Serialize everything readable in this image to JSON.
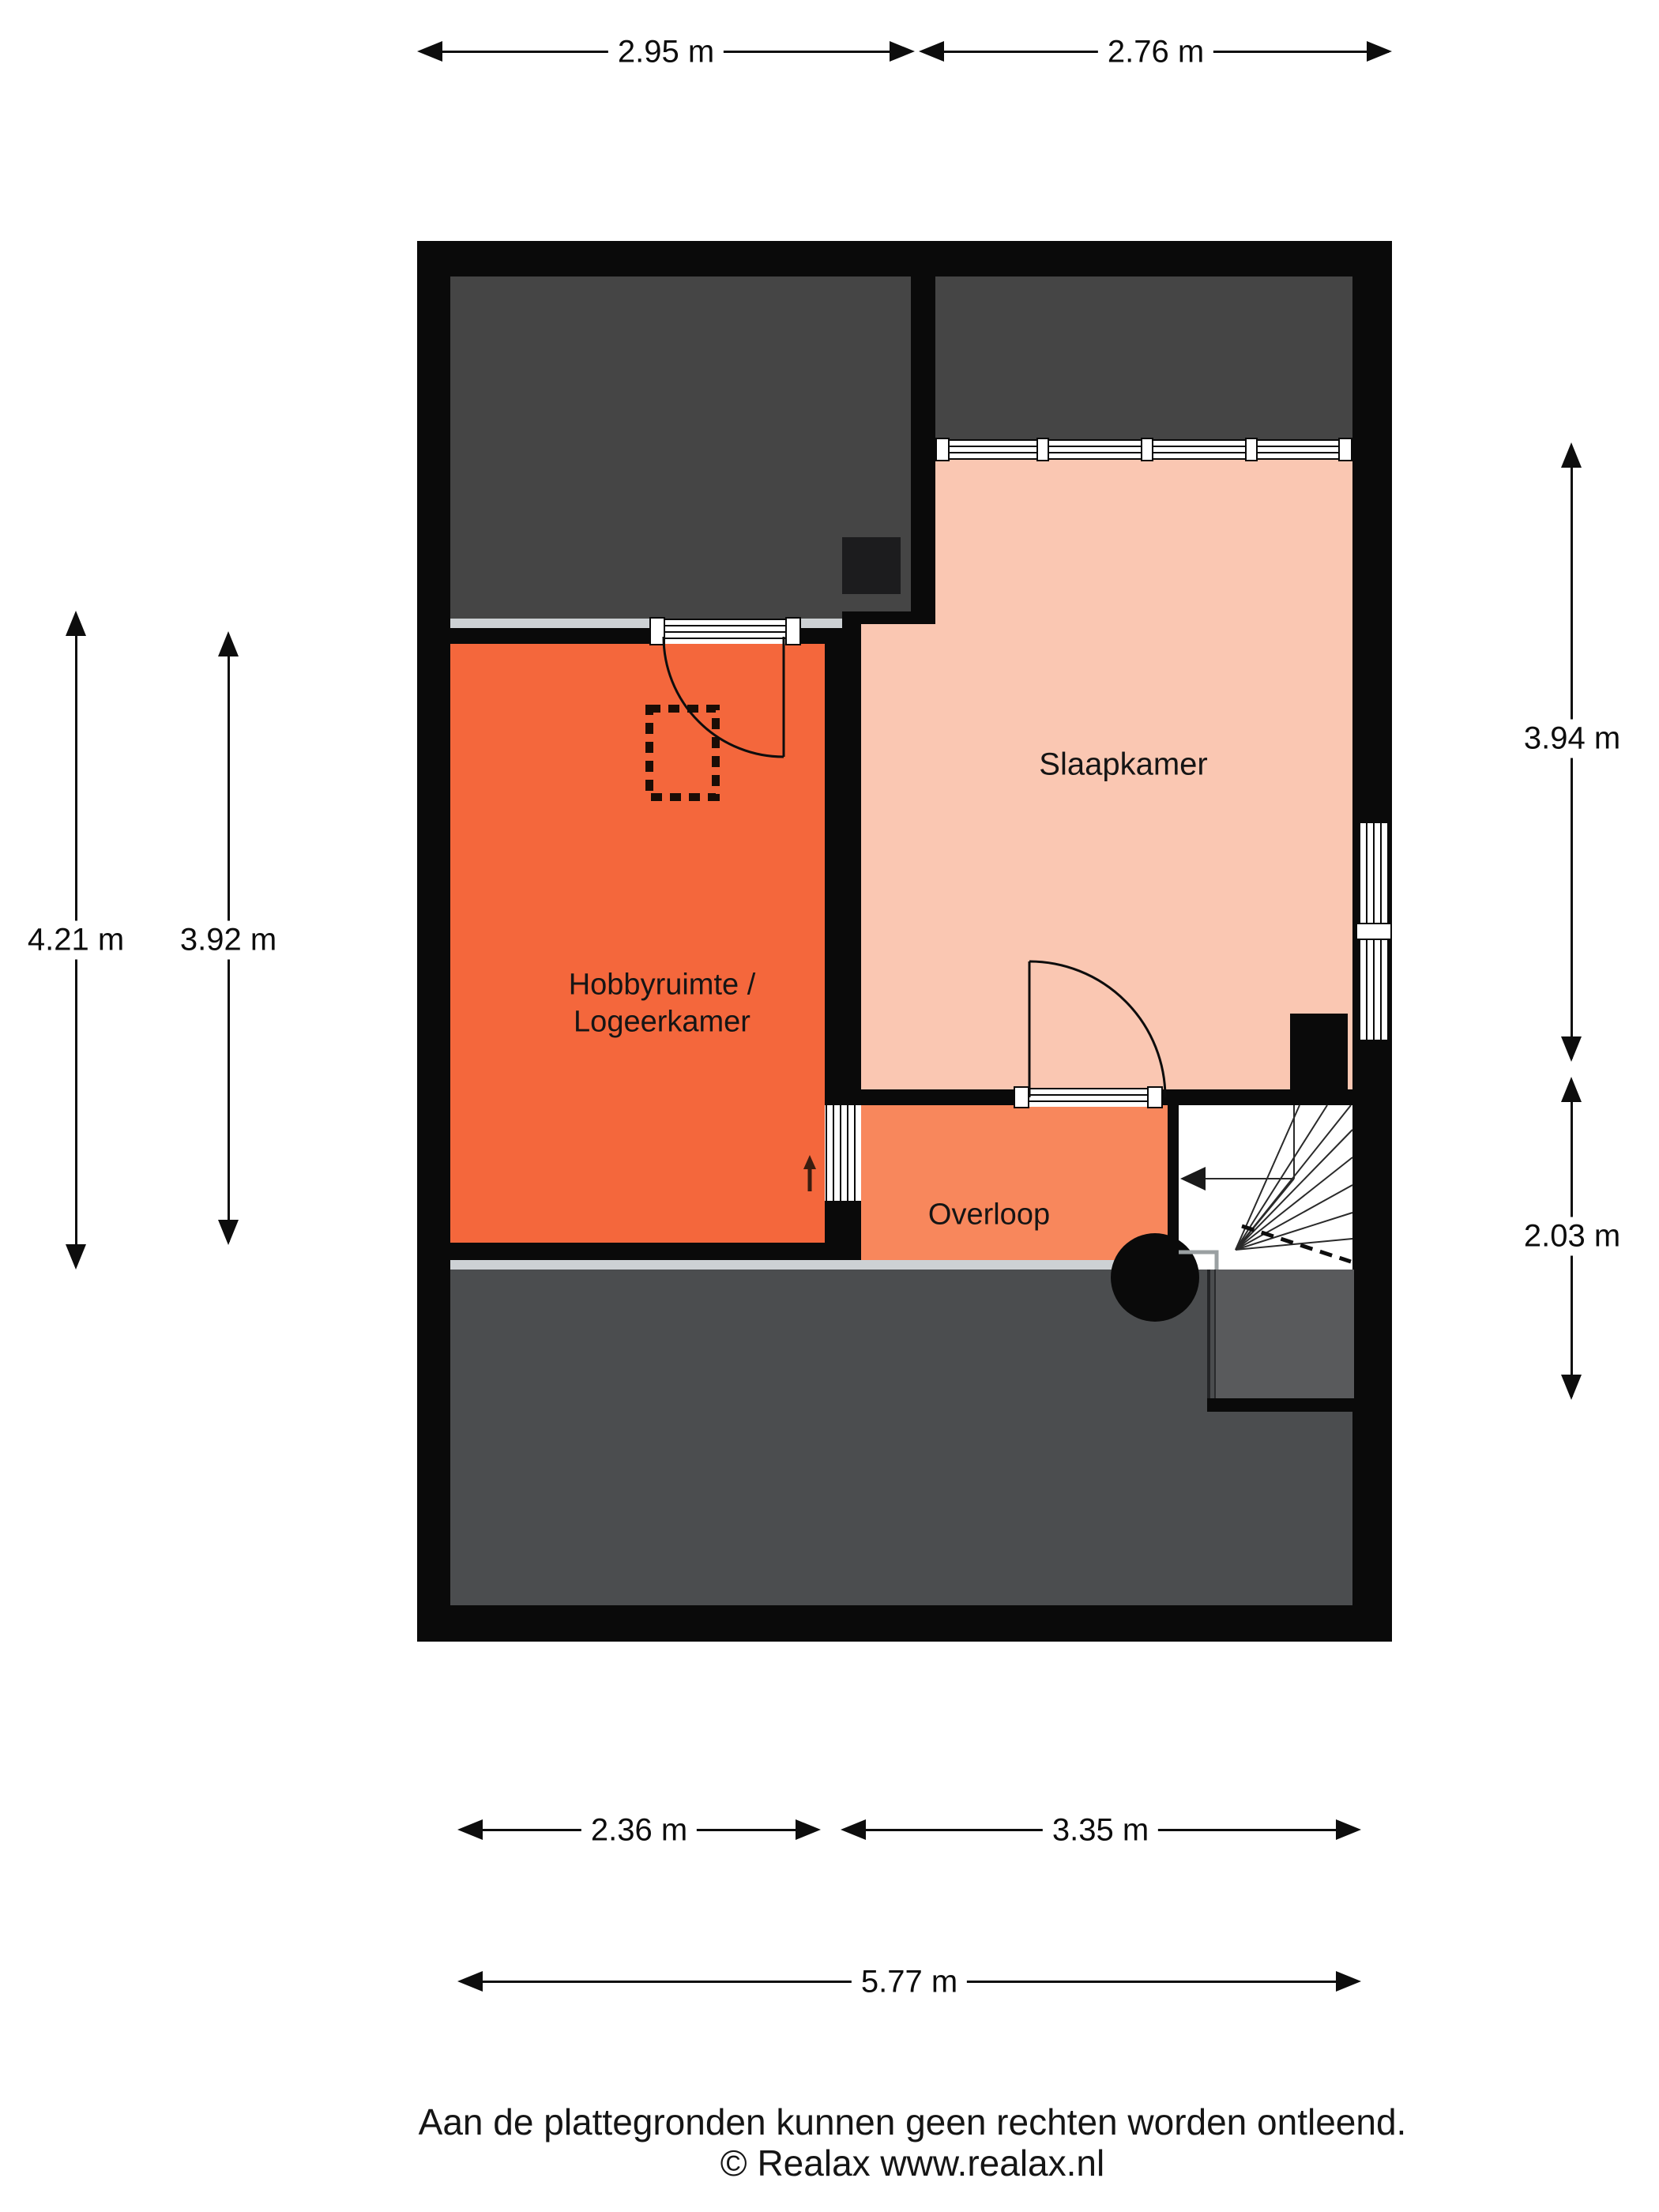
{
  "plan": {
    "type": "floor-plan",
    "floor": "verdieping",
    "rooms": {
      "bedroom_label": "Slaapkamer",
      "hobby_label_line1": "Hobbyruimte /",
      "hobby_label_line2": "Logeerkamer",
      "landing_label": "Overloop"
    },
    "dimensions": {
      "top_left": "2.95 m",
      "top_right": "2.76 m",
      "left_outer": "4.21 m",
      "left_inner": "3.92 m",
      "right_upper": "3.94 m",
      "right_lower": "2.03 m",
      "bottom_left": "2.36 m",
      "bottom_right": "3.35 m",
      "bottom_total": "5.77 m"
    },
    "stairs": {
      "direction": "down-left"
    }
  },
  "footer": {
    "disclaimer": "Aan de plattegronden kunnen geen rechten worden ontleend.",
    "copyright": "© Realax www.realax.nl"
  },
  "colors": {
    "wall": "#0a0a0a",
    "attic_dark": "#454545",
    "attic_lower": "#4b4d4f",
    "hobby_orange": "#f4673c",
    "landing_orange": "#f8875c",
    "bedroom_pink": "#fac7b2",
    "strip_gray": "#cdd1d4",
    "stairwell_gray": "#595a5c"
  }
}
